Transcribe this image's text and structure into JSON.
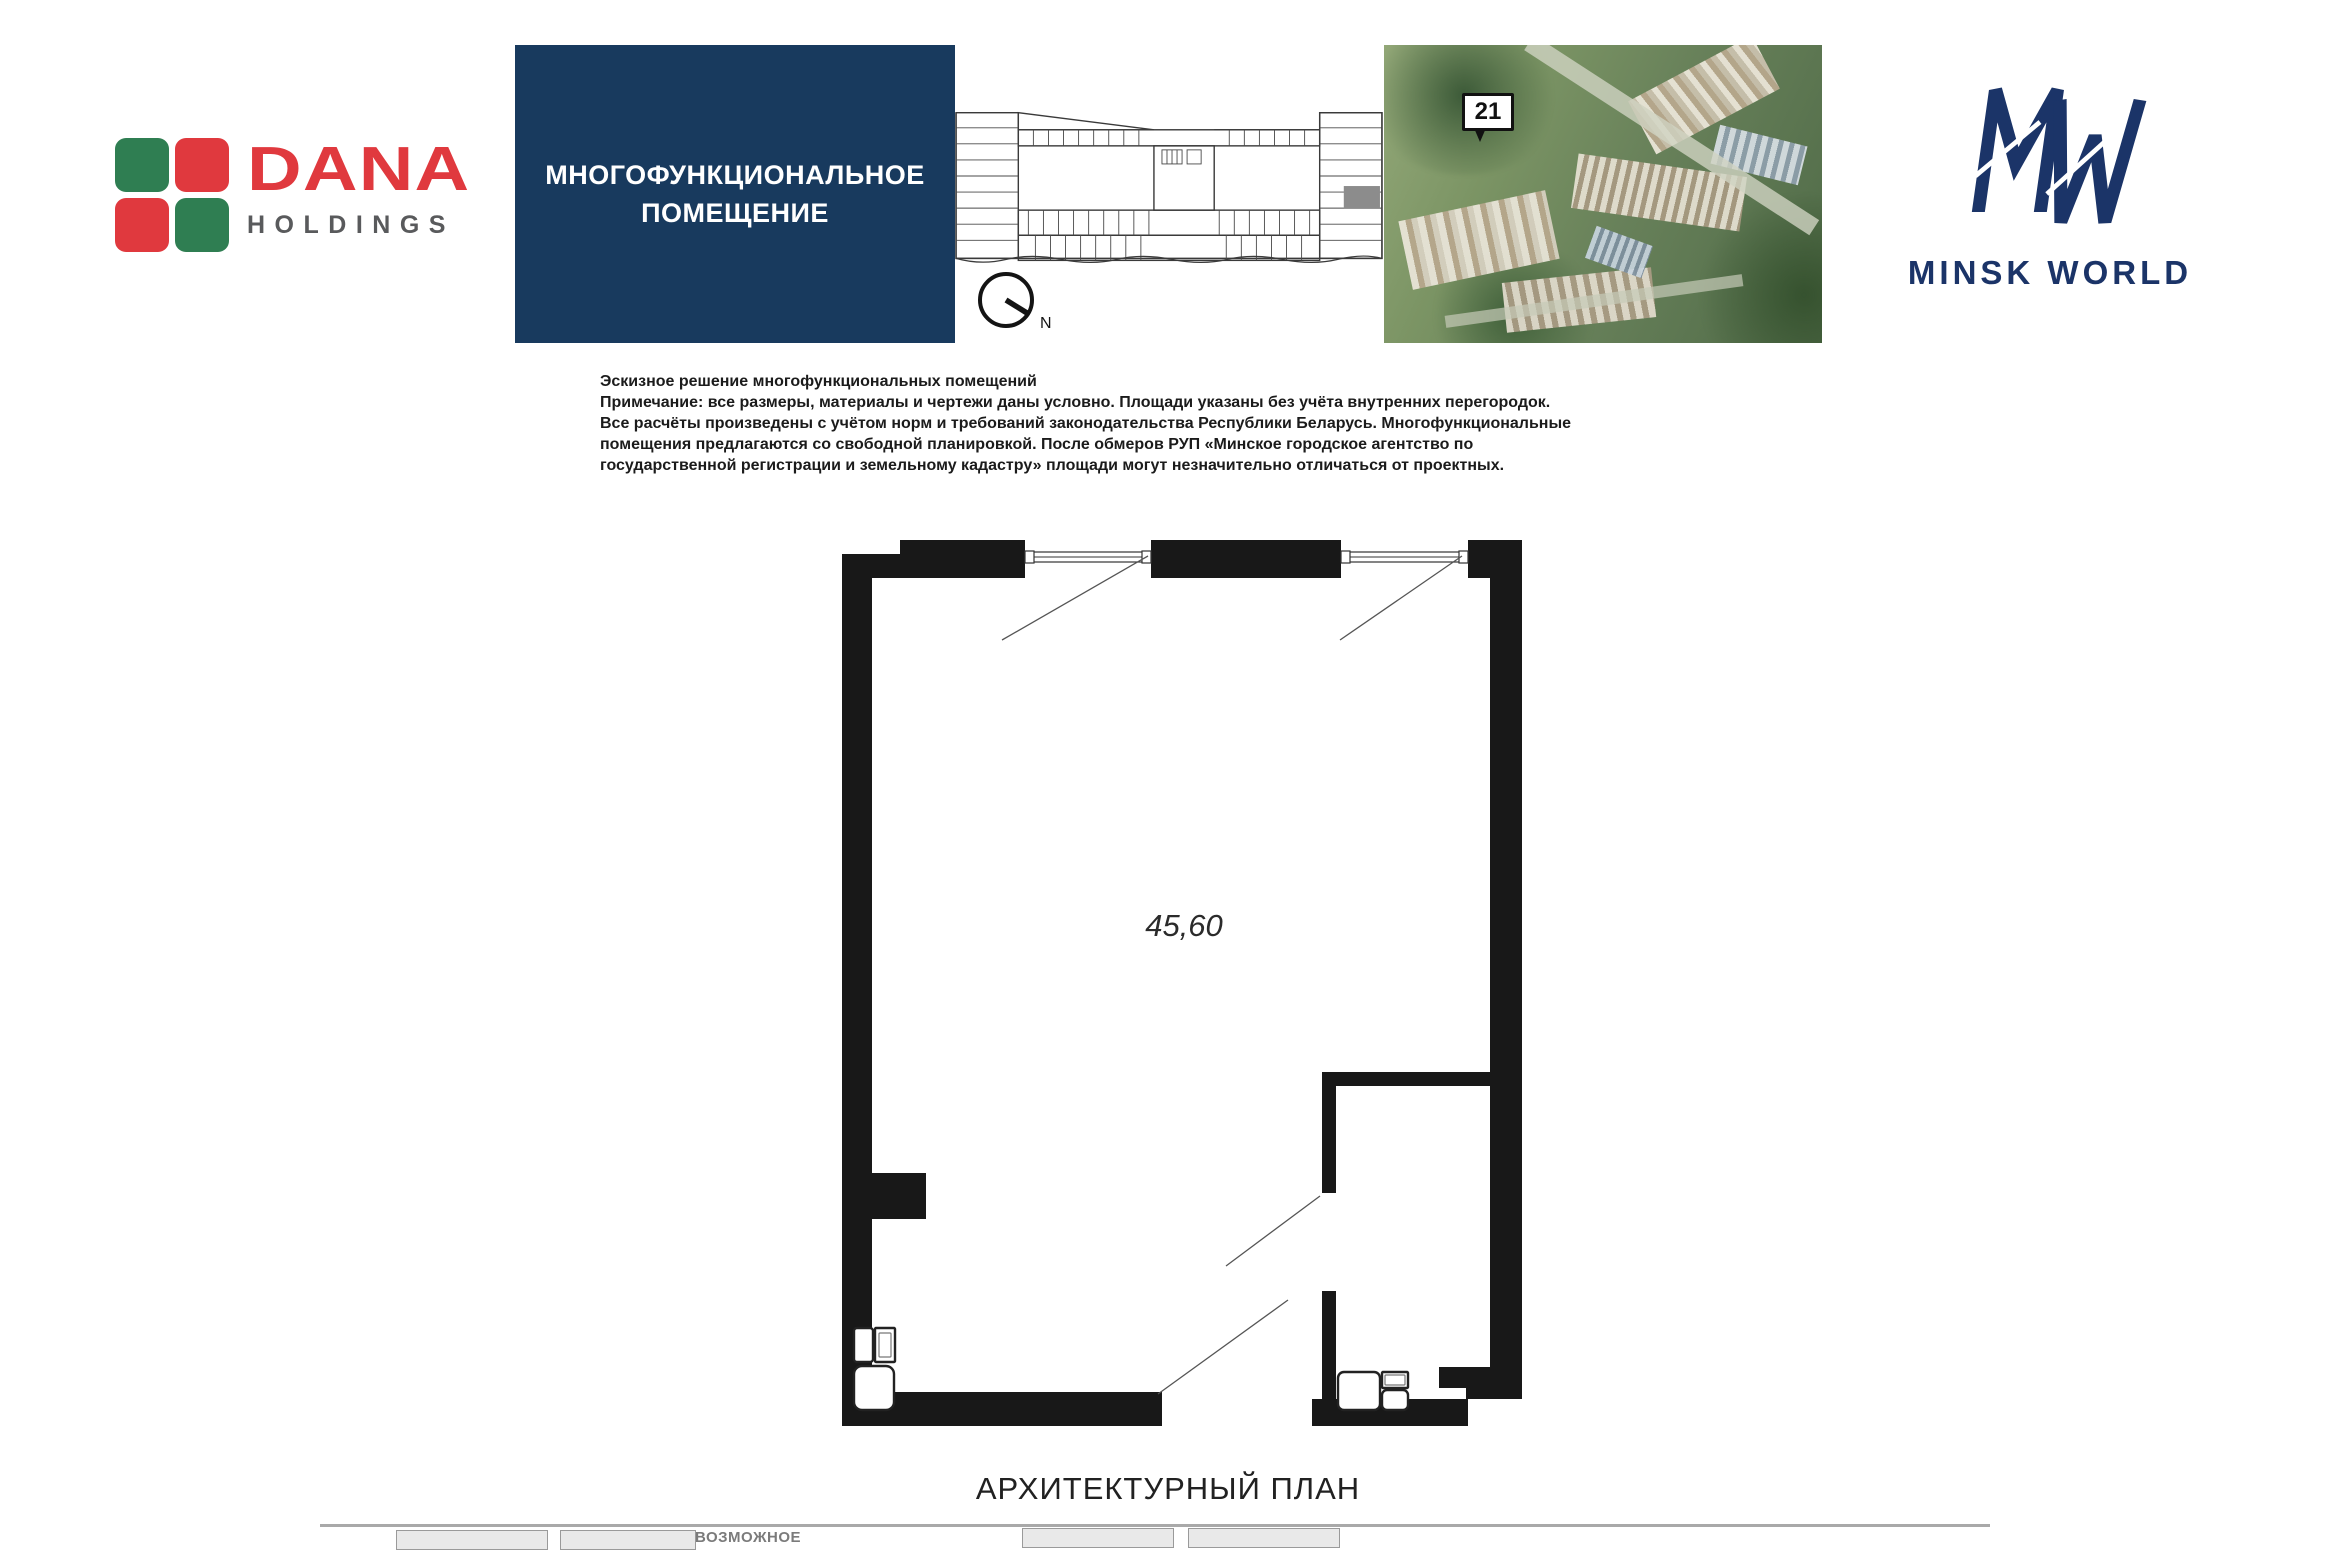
{
  "header": {
    "dana_logo": {
      "brand": "DANA",
      "sub": "HOLDINGS",
      "colors": {
        "red": "#e0393e",
        "green": "#2f7e52",
        "gray": "#595a5c"
      }
    },
    "title_box": {
      "line1": "МНОГОФУНКЦИОНАЛЬНОЕ",
      "line2": "ПОМЕЩЕНИЕ",
      "bg": "#183a5e",
      "text_color": "#ffffff"
    },
    "compass": {
      "north_label": "N"
    },
    "aerial_photo": {
      "location_marker": "21"
    },
    "mw_logo": {
      "brand": "MINSK WORLD",
      "color": "#1b3468"
    }
  },
  "note": {
    "lines": [
      "Эскизное решение многофункциональных помещений",
      "Примечание: все размеры, материалы и чертежи даны условно. Площади указаны без учёта внутренних перегородок.",
      "Все расчёты произведены с учётом норм и требований законодательства Республики Беларусь. Многофункциональные",
      "помещения предлагаются со свободной планировкой. После обмеров РУП «Минское городское агентство по",
      "государственной регистрации и земельному кадастру» площади могут незначительно отличаться от проектных."
    ]
  },
  "plan": {
    "area_label": "45,60"
  },
  "footer": {
    "caption": "АРХИТЕКТУРНЫЙ ПЛАН",
    "partial_legend_text": "ВОЗМОЖНОЕ"
  }
}
